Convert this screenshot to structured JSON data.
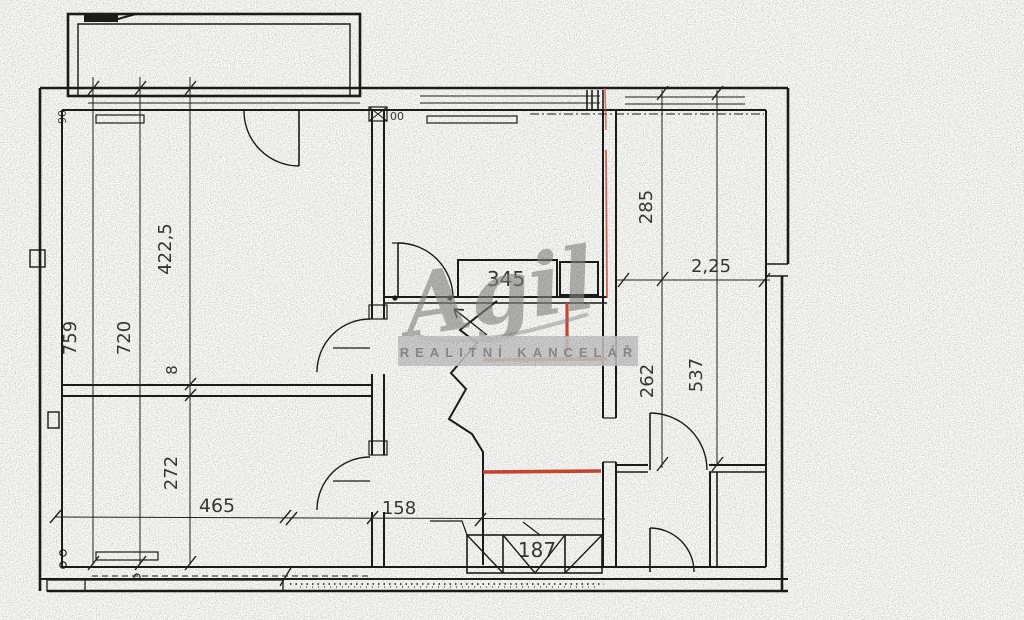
{
  "watermark": {
    "logo": "Agil",
    "band": "REALITNÍ KANCELÁŘ"
  },
  "labels": {
    "v4225": "422,5",
    "v759": "759",
    "v720": "720",
    "v8": "8",
    "v272": "272",
    "h465": "465",
    "h158": "158",
    "h187": "187",
    "c345": "345",
    "v285": "285",
    "h225": "2,25",
    "v262": "262",
    "v537": "537",
    "s00": "00",
    "s90": "90"
  },
  "colors": {
    "ink": "#1d1d1b",
    "red_accent": "#cf4a32",
    "watermark_gray": "#8a8a8a",
    "band_bg": "#c9c9c9",
    "band_text": "#8f8f8f"
  }
}
